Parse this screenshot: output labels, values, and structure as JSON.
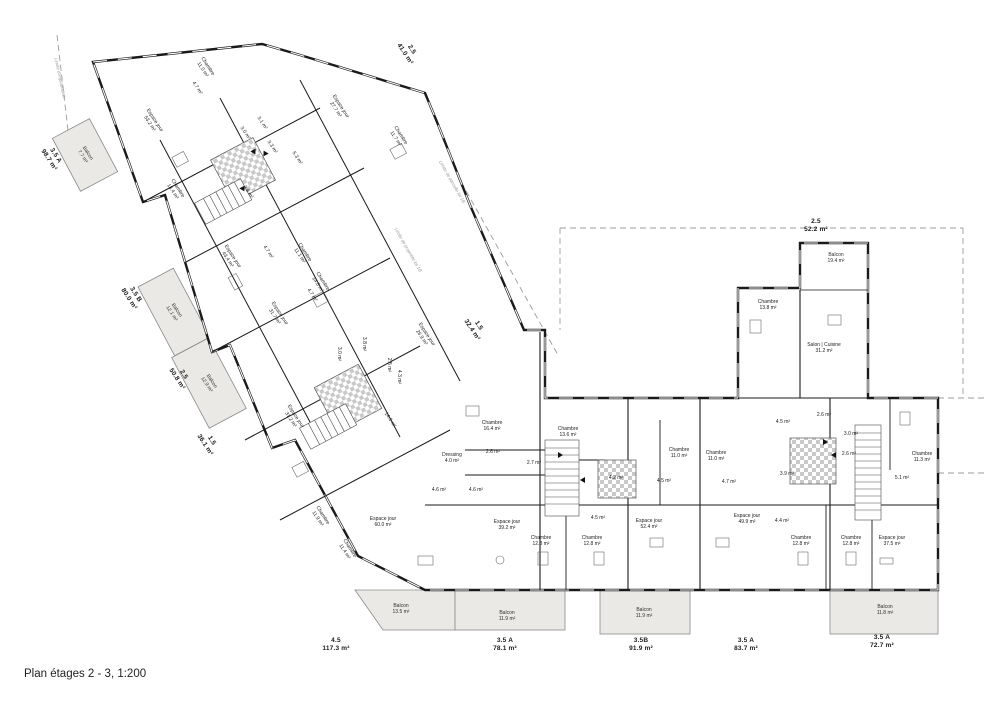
{
  "page": {
    "title": "Plan étages 2 - 3, 1:200"
  },
  "plan": {
    "scale": "1:200",
    "floors": "2 - 3",
    "colors": {
      "wall": "#1a1a1a",
      "balcony_fill": "#eae9e5",
      "checker_tile": "#c9c9c9",
      "dashed_boundary": "#9b9b9b",
      "furniture": "#6a6a6a"
    },
    "labels": [
      {
        "kind": "unit",
        "text": [
          "2.5",
          "41.0 m²"
        ],
        "x": 408,
        "y": 52,
        "rot": 57
      },
      {
        "kind": "unit",
        "text": [
          "3.5 A",
          "98.7 m²"
        ],
        "x": 52,
        "y": 158,
        "rot": 57
      },
      {
        "kind": "unit",
        "text": [
          "3.5 B",
          "80.0 m²"
        ],
        "x": 132,
        "y": 297,
        "rot": 57
      },
      {
        "kind": "unit",
        "text": [
          "2.5",
          "50.8 m²"
        ],
        "x": 180,
        "y": 377,
        "rot": 57
      },
      {
        "kind": "unit",
        "text": [
          "1.5",
          "36.1 m²"
        ],
        "x": 208,
        "y": 443,
        "rot": 57
      },
      {
        "kind": "unit",
        "text": [
          "1.5",
          "32.4 m²"
        ],
        "x": 475,
        "y": 328,
        "rot": 57
      },
      {
        "kind": "unit",
        "text": [
          "2.5",
          "52.2 m²"
        ],
        "x": 816,
        "y": 226,
        "rot": 0
      },
      {
        "kind": "unit",
        "text": [
          "4.5",
          "117.3 m²"
        ],
        "x": 336,
        "y": 645,
        "rot": 0
      },
      {
        "kind": "unit",
        "text": [
          "3.5 A",
          "78.1 m²"
        ],
        "x": 505,
        "y": 645,
        "rot": 0
      },
      {
        "kind": "unit",
        "text": [
          "3.5B",
          "91.9 m²"
        ],
        "x": 641,
        "y": 645,
        "rot": 0
      },
      {
        "kind": "unit",
        "text": [
          "3.5 A",
          "83.7 m²"
        ],
        "x": 746,
        "y": 645,
        "rot": 0
      },
      {
        "kind": "unit",
        "text": [
          "3.5 A",
          "72.7 m²"
        ],
        "x": 882,
        "y": 642,
        "rot": 0
      },
      {
        "kind": "room",
        "text": [
          "Chambre",
          "11.0 m²"
        ],
        "x": 205,
        "y": 68,
        "rot": 57
      },
      {
        "kind": "room",
        "text": [
          "4.7 m²"
        ],
        "x": 197,
        "y": 88,
        "rot": 57
      },
      {
        "kind": "room",
        "text": [
          "Espace jour",
          "53.2 m²"
        ],
        "x": 152,
        "y": 122,
        "rot": 57
      },
      {
        "kind": "room",
        "text": [
          "3.1 m²"
        ],
        "x": 262,
        "y": 123,
        "rot": 57
      },
      {
        "kind": "room",
        "text": [
          "3.0 m²"
        ],
        "x": 245,
        "y": 133,
        "rot": 57
      },
      {
        "kind": "room",
        "text": [
          "3.3 m²"
        ],
        "x": 272,
        "y": 147,
        "rot": 57
      },
      {
        "kind": "room",
        "text": [
          "5.3 m²"
        ],
        "x": 297,
        "y": 158,
        "rot": 57
      },
      {
        "kind": "room",
        "text": [
          "Chambre",
          "13.4 m²"
        ],
        "x": 175,
        "y": 190,
        "rot": 57
      },
      {
        "kind": "room",
        "text": [
          "3.9 m²"
        ],
        "x": 248,
        "y": 192,
        "rot": 57
      },
      {
        "kind": "room",
        "text": [
          "Espace jour",
          "27.7 m²"
        ],
        "x": 338,
        "y": 108,
        "rot": 57
      },
      {
        "kind": "room",
        "text": [
          "Chambre",
          "11.7 m²"
        ],
        "x": 398,
        "y": 137,
        "rot": 57
      },
      {
        "kind": "room",
        "text": [
          "Espace jour",
          "43.4 m²"
        ],
        "x": 230,
        "y": 258,
        "rot": 57
      },
      {
        "kind": "room",
        "text": [
          "4.7 m²"
        ],
        "x": 268,
        "y": 252,
        "rot": 57
      },
      {
        "kind": "room",
        "text": [
          "Chambre",
          "11.1 m²"
        ],
        "x": 302,
        "y": 254,
        "rot": 57
      },
      {
        "kind": "room",
        "text": [
          "Chambre",
          "14.8 m²"
        ],
        "x": 320,
        "y": 283,
        "rot": 57
      },
      {
        "kind": "room",
        "text": [
          "4.7 m²"
        ],
        "x": 312,
        "y": 295,
        "rot": 57
      },
      {
        "kind": "room",
        "text": [
          "Espace jour",
          "31.7 m²"
        ],
        "x": 277,
        "y": 315,
        "rot": 57
      },
      {
        "kind": "room",
        "text": [
          "Espace jour",
          "26.9 m²"
        ],
        "x": 424,
        "y": 336,
        "rot": 57
      },
      {
        "kind": "room",
        "text": [
          "Espace jour",
          "31.2 m²"
        ],
        "x": 293,
        "y": 418,
        "rot": 57
      },
      {
        "kind": "room",
        "text": [
          "14.3 m²"
        ],
        "x": 390,
        "y": 420,
        "rot": 57
      },
      {
        "kind": "room",
        "text": [
          "Chambre",
          "11.9 m²"
        ],
        "x": 320,
        "y": 517,
        "rot": 57
      },
      {
        "kind": "room",
        "text": [
          "Chambre",
          "11.4 m²"
        ],
        "x": 347,
        "y": 550,
        "rot": 57
      },
      {
        "kind": "room",
        "text": [
          "3.8 m²"
        ],
        "x": 364,
        "y": 344,
        "rot": 90
      },
      {
        "kind": "room",
        "text": [
          "3.0 m²"
        ],
        "x": 339,
        "y": 354,
        "rot": 90
      },
      {
        "kind": "room",
        "text": [
          "2.5 m²"
        ],
        "x": 389,
        "y": 365,
        "rot": 90
      },
      {
        "kind": "room",
        "text": [
          "4.3 m²"
        ],
        "x": 399,
        "y": 377,
        "rot": 90
      },
      {
        "kind": "balcony",
        "text": [
          "Balcon",
          "7.7 m²"
        ],
        "x": 85,
        "y": 155,
        "rot": 57
      },
      {
        "kind": "balcony",
        "text": [
          "Balcon",
          "12.1 m²"
        ],
        "x": 174,
        "y": 312,
        "rot": 57
      },
      {
        "kind": "balcony",
        "text": [
          "Balcon",
          "12.9 m²"
        ],
        "x": 209,
        "y": 383,
        "rot": 57
      },
      {
        "kind": "balcony",
        "text": [
          "Balcon",
          "19.4 m²"
        ],
        "x": 836,
        "y": 258,
        "rot": 0
      },
      {
        "kind": "balcony",
        "text": [
          "Balcon",
          "13.5 m²"
        ],
        "x": 401,
        "y": 609,
        "rot": 0
      },
      {
        "kind": "balcony",
        "text": [
          "Balcon",
          "11.9 m²"
        ],
        "x": 507,
        "y": 616,
        "rot": 0
      },
      {
        "kind": "balcony",
        "text": [
          "Balcon",
          "11.9 m²"
        ],
        "x": 644,
        "y": 613,
        "rot": 0
      },
      {
        "kind": "balcony",
        "text": [
          "Balcon",
          "11.8 m²"
        ],
        "x": 885,
        "y": 610,
        "rot": 0
      },
      {
        "kind": "room",
        "text": [
          "Chambre",
          "13.8 m²"
        ],
        "x": 768,
        "y": 305,
        "rot": 0
      },
      {
        "kind": "room",
        "text": [
          "Salon | Cuisine",
          "31.2 m²"
        ],
        "x": 824,
        "y": 348,
        "rot": 0
      },
      {
        "kind": "room",
        "text": [
          "Chambre",
          "16.4 m²"
        ],
        "x": 492,
        "y": 426,
        "rot": 0
      },
      {
        "kind": "room",
        "text": [
          "Dressing",
          "4.0 m²"
        ],
        "x": 452,
        "y": 458,
        "rot": 0
      },
      {
        "kind": "room",
        "text": [
          "2.6 m²"
        ],
        "x": 493,
        "y": 452,
        "rot": 0
      },
      {
        "kind": "room",
        "text": [
          "2.7 m²"
        ],
        "x": 534,
        "y": 463,
        "rot": 0
      },
      {
        "kind": "room",
        "text": [
          "4.6 m²"
        ],
        "x": 439,
        "y": 490,
        "rot": 0
      },
      {
        "kind": "room",
        "text": [
          "4.6 m²"
        ],
        "x": 476,
        "y": 490,
        "rot": 0
      },
      {
        "kind": "room",
        "text": [
          "Chambre",
          "13.6 m²"
        ],
        "x": 568,
        "y": 432,
        "rot": 0
      },
      {
        "kind": "room",
        "text": [
          "4.2 m²"
        ],
        "x": 616,
        "y": 478,
        "rot": 0
      },
      {
        "kind": "room",
        "text": [
          "4.5 m²"
        ],
        "x": 598,
        "y": 518,
        "rot": 0
      },
      {
        "kind": "room",
        "text": [
          "4.5 m²"
        ],
        "x": 664,
        "y": 481,
        "rot": 0
      },
      {
        "kind": "room",
        "text": [
          "Chambre",
          "11.0 m²"
        ],
        "x": 679,
        "y": 453,
        "rot": 0
      },
      {
        "kind": "room",
        "text": [
          "Chambre",
          "11.0 m²"
        ],
        "x": 716,
        "y": 456,
        "rot": 0
      },
      {
        "kind": "room",
        "text": [
          "4.7 m²"
        ],
        "x": 729,
        "y": 482,
        "rot": 0
      },
      {
        "kind": "room",
        "text": [
          "Espace jour",
          "52.4 m²"
        ],
        "x": 649,
        "y": 524,
        "rot": 0
      },
      {
        "kind": "room",
        "text": [
          "Espace jour",
          "49.9 m²"
        ],
        "x": 747,
        "y": 519,
        "rot": 0
      },
      {
        "kind": "room",
        "text": [
          "3.9 m²"
        ],
        "x": 787,
        "y": 474,
        "rot": 0
      },
      {
        "kind": "room",
        "text": [
          "4.4 m²"
        ],
        "x": 782,
        "y": 521,
        "rot": 0
      },
      {
        "kind": "room",
        "text": [
          "4.5 m²"
        ],
        "x": 783,
        "y": 422,
        "rot": 0
      },
      {
        "kind": "room",
        "text": [
          "2.6 m²"
        ],
        "x": 824,
        "y": 415,
        "rot": 0
      },
      {
        "kind": "room",
        "text": [
          "3.0 m²"
        ],
        "x": 851,
        "y": 434,
        "rot": 0
      },
      {
        "kind": "room",
        "text": [
          "2.6 m²"
        ],
        "x": 849,
        "y": 454,
        "rot": 0
      },
      {
        "kind": "room",
        "text": [
          "Chambre",
          "11.3 m²"
        ],
        "x": 922,
        "y": 457,
        "rot": 0
      },
      {
        "kind": "room",
        "text": [
          "5.1 m²"
        ],
        "x": 902,
        "y": 478,
        "rot": 0
      },
      {
        "kind": "room",
        "text": [
          "Espace jour",
          "39.2 m²"
        ],
        "x": 507,
        "y": 525,
        "rot": 0
      },
      {
        "kind": "room",
        "text": [
          "Chambre",
          "12.8 m²"
        ],
        "x": 541,
        "y": 541,
        "rot": 0
      },
      {
        "kind": "room",
        "text": [
          "Chambre",
          "12.8 m²"
        ],
        "x": 592,
        "y": 541,
        "rot": 0
      },
      {
        "kind": "room",
        "text": [
          "Chambre",
          "12.8 m²"
        ],
        "x": 801,
        "y": 541,
        "rot": 0
      },
      {
        "kind": "room",
        "text": [
          "Chambre",
          "12.8 m²"
        ],
        "x": 851,
        "y": 541,
        "rot": 0
      },
      {
        "kind": "room",
        "text": [
          "Espace jour",
          "37.5 m²"
        ],
        "x": 892,
        "y": 541,
        "rot": 0
      },
      {
        "kind": "room",
        "text": [
          "Espace jour",
          "60.0 m²"
        ],
        "x": 383,
        "y": 522,
        "rot": 0
      },
      {
        "kind": "boundary",
        "text": [
          "Limite d'implantation"
        ],
        "x": 60,
        "y": 78,
        "rot": 78
      },
      {
        "kind": "boundary",
        "text": [
          "Limite de parcelle lot 1B"
        ],
        "x": 452,
        "y": 182,
        "rot": 60
      },
      {
        "kind": "boundary",
        "text": [
          "Limite de propriété lot 1B"
        ],
        "x": 408,
        "y": 250,
        "rot": 60
      }
    ]
  }
}
